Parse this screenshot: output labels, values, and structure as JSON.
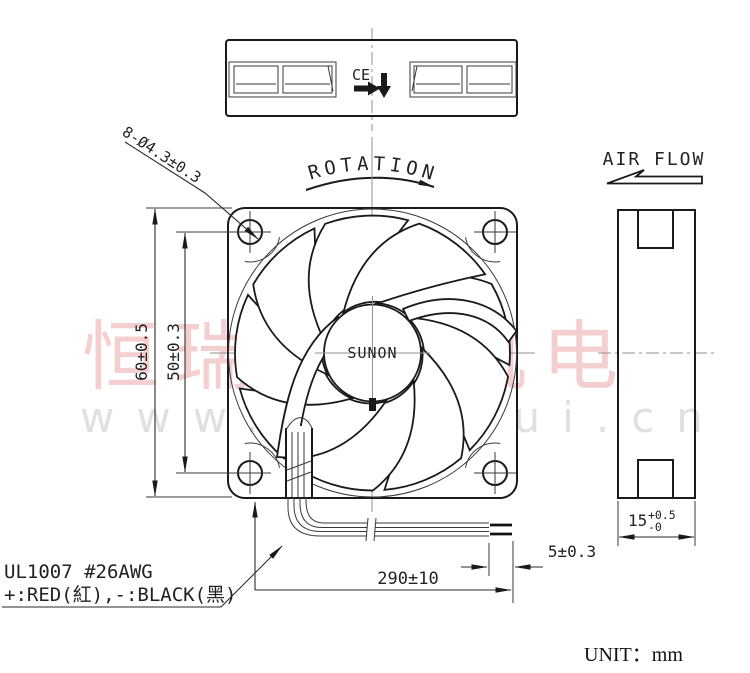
{
  "labels": {
    "rotation": "ROTATION",
    "air_flow": "AIR FLOW",
    "brand": "SUNON",
    "ce_mark": "CE",
    "unit": "UNIT：mm"
  },
  "dimensions": {
    "mounting_holes": "8-Ø4.3±0.3",
    "frame_size": "60±0.5",
    "hole_pitch": "50±0.3",
    "wire_length": "290±10",
    "strip_length": "5±0.3",
    "thickness_value": "15",
    "thickness_plus": "+0.5",
    "thickness_minus": "-0"
  },
  "wire_spec": {
    "line1": "UL1007  #26AWG",
    "line2": "+:RED(紅),-:BLACK(黑)"
  },
  "watermark": {
    "cn_text": "恒瑞宏易机电",
    "url_text": "www.hengrui.cn",
    "cn_color": "#eba8a8",
    "url_color": "#cccccc"
  },
  "colors": {
    "line": "#1a1a1a",
    "centerline": "#919191"
  }
}
